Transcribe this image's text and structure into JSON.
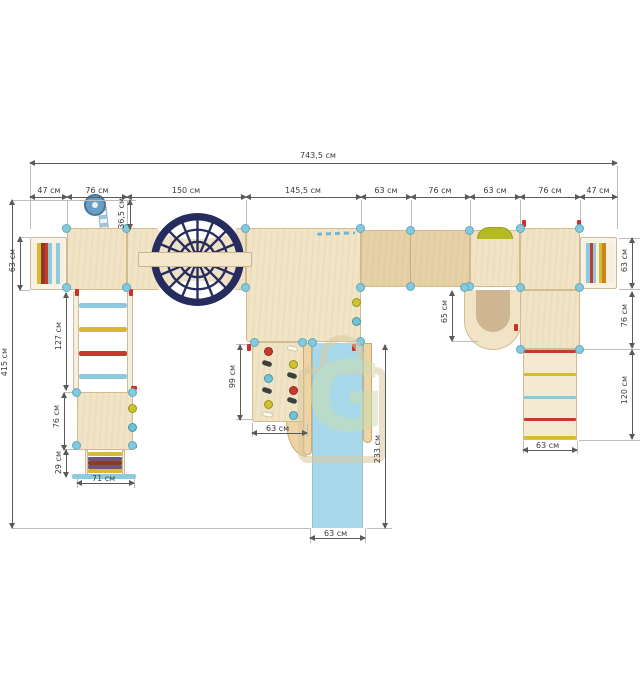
{
  "dims": {
    "total_width": "743,5 см",
    "top_segments": [
      "47 см",
      "76 см",
      "150 см",
      "145,5 см",
      "63 см",
      "76 см",
      "63 см",
      "76 см",
      "47 см"
    ],
    "periscope": "36,5 см",
    "total_depth": "415 см",
    "ladder_left": "63 см",
    "climb_ladder": "127 см",
    "platform_left": "76 см",
    "steps": "29 см",
    "base_left": "71 см",
    "wall_h": "99 см",
    "wall_w": "63 см",
    "slide_len": "233 см",
    "slide_w": "63 см",
    "tunnel": "65 см",
    "ladder_right": "63 см",
    "platform_right": "76 см",
    "ramp_len": "120 см",
    "ramp_w": "63 см"
  },
  "watermark": {
    "letter": "G"
  },
  "colors": {
    "wood_light": "#f1e4c6",
    "wood_mid": "#e7d2a8",
    "wood_edge": "#d2bb8e",
    "wood_shadow": "#cdb691",
    "cap_blue": "#85c9dc",
    "cap_blue_dark": "#5fa9c2",
    "cap_red": "#cf2f26",
    "net_navy": "#272c5f",
    "slide_blue": "#a7d9eb",
    "olive": "#b4ba25",
    "stripe_yellow": "#d9b92f",
    "stripe_red": "#c8382c",
    "stripe_darkred": "#8e3a28",
    "stripe_blue": "#8ccade",
    "stripe_purple": "#6f5577",
    "stripe_orange": "#c8861f",
    "hold_yellow": "#cfc32d",
    "hold_blue": "#6fc3d8",
    "hold_dark": "#3c403c",
    "dim": "#5a5a5a",
    "wm_green": "#cdddb0",
    "wm_tan": "#dbc9a2"
  }
}
